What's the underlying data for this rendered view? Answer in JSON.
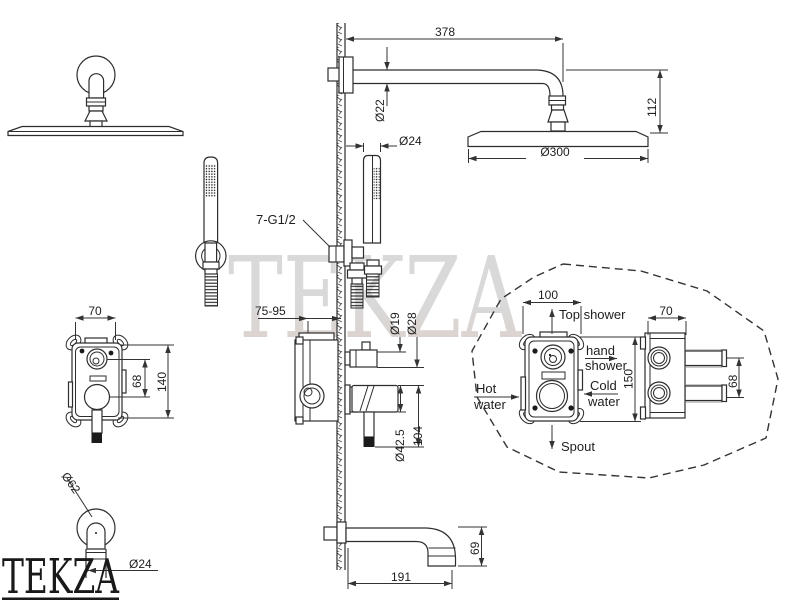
{
  "watermark": {
    "text": "TEKZA"
  },
  "logo": {
    "text": "TEKZA"
  },
  "dims": {
    "arm_length": "378",
    "arm_dia": "Ø22",
    "handshower_dia": "Ø24",
    "drop_height": "112",
    "head_dia": "Ø300",
    "thread": "7-G1/2",
    "valve_width": "70",
    "valve_centers": "68",
    "valve_height": "140",
    "recess_depth": "75-95",
    "stem_dia": "Ø19",
    "knob_dia": "Ø28",
    "handle_dia": "Ø42.5",
    "handle_len": "104",
    "spout_face_dia": "Ø62",
    "spout_pipe_dia": "Ø24",
    "spout_len": "191",
    "spout_drop": "69",
    "box_width": "100",
    "box_height": "150",
    "box_depth": "70",
    "box_ports": "68"
  },
  "flows": {
    "top_shower": "Top shower",
    "hand_line1": "hand",
    "hand_line2": "shower",
    "cold_line1": "Cold",
    "cold_line2": "water",
    "hot_line1": "Hot",
    "hot_line2": "water",
    "spout": "Spout"
  }
}
